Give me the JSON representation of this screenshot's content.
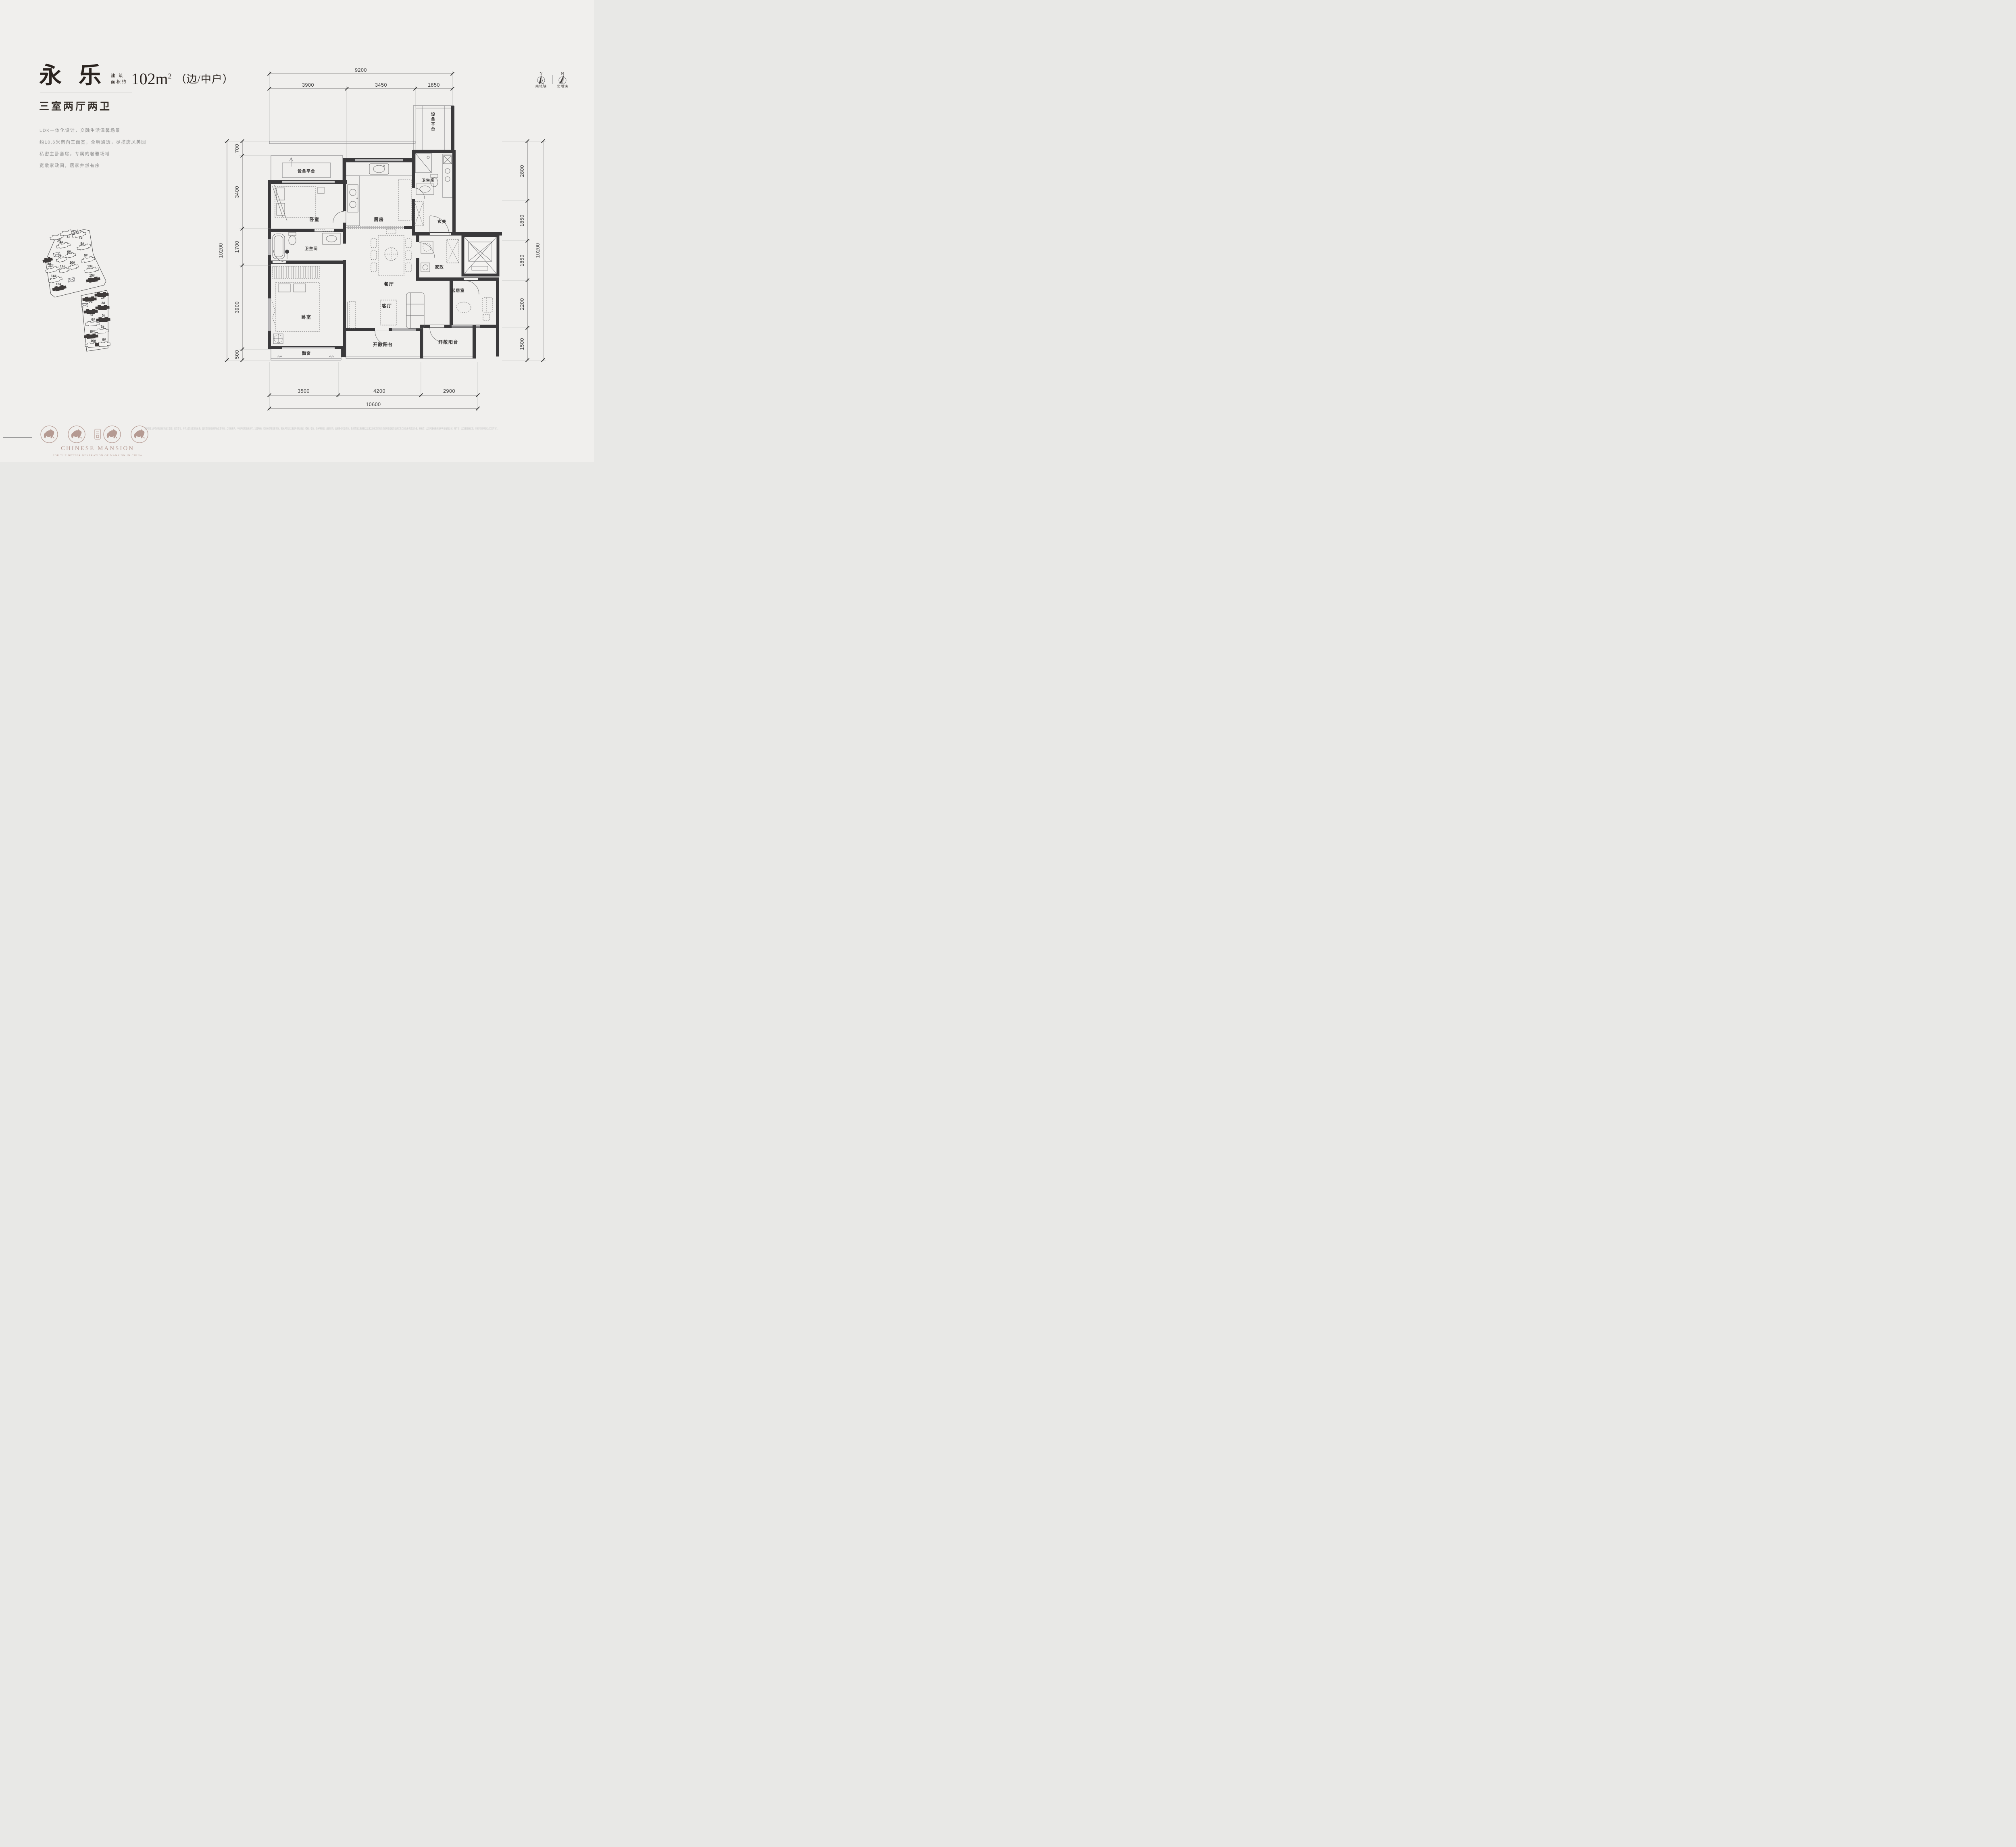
{
  "header": {
    "name": "永 乐",
    "area_label_1": "建 筑",
    "area_label_2": "面积约",
    "area_value": "102m",
    "area_sup": "2",
    "unit_type": "（边/中户）",
    "subtitle": "三室两厅两卫"
  },
  "description": {
    "lines": [
      "LDK一体化设计，交融生活温馨场景",
      "约10.6米南向三面宽，全明通透，尽揽唐风美园",
      "私密主卧套房，专属的奢雅场域",
      "宽敞家政间，居家井然有序"
    ]
  },
  "compass": {
    "north_label": "N",
    "south_plot": "南地块",
    "north_plot": "北地块"
  },
  "rooms": {
    "equip_top": "设备平台",
    "equip_left": "设备平台",
    "bedroom1": "卧室",
    "kitchen": "厨房",
    "bath1": "卫生间",
    "foyer": "玄关",
    "dining": "餐厅",
    "laundry": "家政",
    "bath2": "卫生间",
    "bedroom2": "卧室",
    "living": "客厅",
    "family": "起居室",
    "bay": "飘窗",
    "balcony1": "开敞阳台",
    "balcony2": "开敞阳台"
  },
  "dims": {
    "top": {
      "total": "9200",
      "segs": [
        "3900",
        "3450",
        "1850"
      ]
    },
    "left": {
      "total": "10200",
      "segs": [
        "700",
        "3400",
        "1700",
        "3900",
        "500"
      ]
    },
    "right": {
      "total": "10200",
      "segs": [
        "2800",
        "1850",
        "1850",
        "2200",
        "1500"
      ]
    },
    "bottom": {
      "total": "10600",
      "segs": [
        "3500",
        "4200",
        "2900"
      ]
    }
  },
  "sitemap": {
    "south": [
      "3#",
      "2#",
      "1#",
      "4#",
      "5#",
      "6#",
      "7#",
      "9#",
      "8#",
      "10#",
      "11#",
      "12#",
      "13#",
      "14#",
      "15#",
      "16#"
    ],
    "north": [
      "2#",
      "1#",
      "3#",
      "4#",
      "5#",
      "6#",
      "7#",
      "8#",
      "9#",
      "10#"
    ]
  },
  "footer": {
    "brand": "CHINESE MANSION",
    "tagline": "FOR THE BETTER GENERATION OF MANSION IN CHINA",
    "disclaimer": "本户型图为户型的标准层平面示意图，仅供参考，不作为要约或销售承诺。具体选购房源因所处位置不同，会存在差异。不同户型的面积尺寸、功能布局、空间分割等均有不同，相同户型因标准层与非标准层、楼栋、楼层、单元等差别，局部结构、面积等也可能不同，具体情况以政府最后批准之法律文件和买卖双方签订的商品房买卖合同及补充协议为准。开发商：北京兴诚未来房地产开发有限公司；推广名：北京国贤府贰期。本资料制作时间为2025年3月。"
  },
  "colors": {
    "background": "#f0efed",
    "wall": "#3a393b",
    "accent": "#b59a92",
    "dim_text": "#4f4f4f"
  }
}
